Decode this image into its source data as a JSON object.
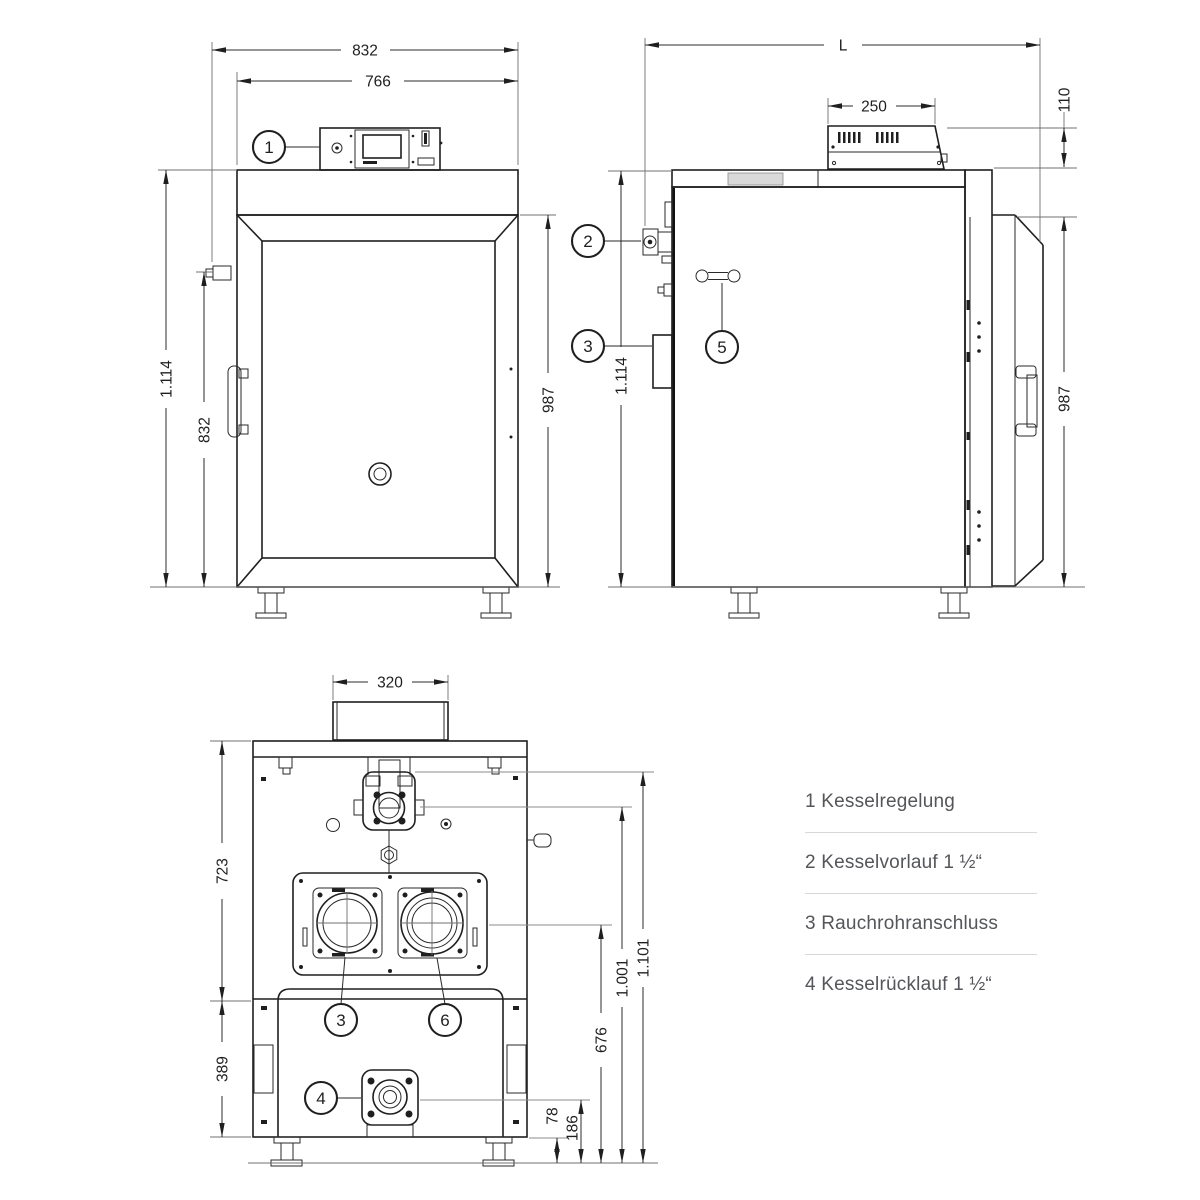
{
  "dims": {
    "front": {
      "total_width": "832",
      "inner_width": "766",
      "total_height": "1.114",
      "door_height": "832",
      "body_height": "987"
    },
    "side": {
      "length": "L",
      "panel_width": "250",
      "panel_height": "110",
      "total_height": "1.114",
      "body_height": "987"
    },
    "back": {
      "duct_width": "320",
      "upper_height": "723",
      "lower_height": "389",
      "flue_height": "676",
      "foot_height": "78",
      "return_height": "186",
      "vorlauf_height": "1.001",
      "top_height": "1.101"
    }
  },
  "callouts": {
    "c1": "1",
    "c2": "2",
    "c3": "3",
    "c4": "4",
    "c5": "5",
    "c6": "6"
  },
  "legend": {
    "items": [
      {
        "text": "1 Kesselregelung"
      },
      {
        "text": "2 Kesselvorlauf 1 ½“"
      },
      {
        "text": "3 Rauchrohranschluss"
      },
      {
        "text": "4 Kesselrücklauf 1 ½“"
      }
    ]
  }
}
